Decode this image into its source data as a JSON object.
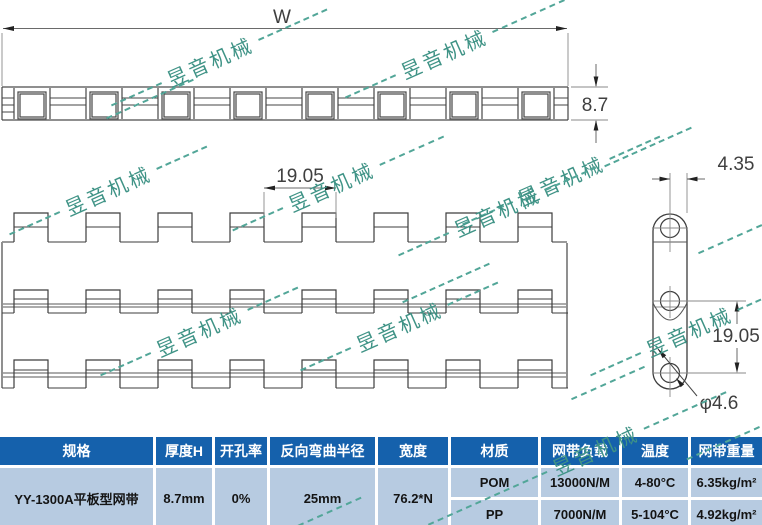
{
  "watermark": {
    "text": "昱音机械",
    "color": "#3f9386"
  },
  "drawing": {
    "dim_width_label": "W",
    "dim_thickness": "8.7",
    "dim_pitch": "19.05",
    "dim_plate_width": "4.35",
    "dim_hole_pitch": "19.05",
    "dim_hole_diameter": "φ4.6"
  },
  "table": {
    "headers": [
      "规格",
      "厚度H",
      "开孔率",
      "反向弯曲半径",
      "宽度",
      "材质",
      "网带负载",
      "温度",
      "网带重量"
    ],
    "row": {
      "spec": "YY-1300A平板型网带",
      "thickness": "8.7mm",
      "open_ratio": "0%",
      "bend_radius": "25mm",
      "width": "76.2*N"
    },
    "materials": [
      {
        "name": "POM",
        "load": "13000N/M",
        "temp": "4-80°C",
        "weight": "6.35kg/m²"
      },
      {
        "name": "PP",
        "load": "7000N/M",
        "temp": "5-104°C",
        "weight": "4.92kg/m²"
      }
    ]
  },
  "colors": {
    "table_header_bg": "#1561ac",
    "table_body_bg": "#b7cbe1"
  }
}
